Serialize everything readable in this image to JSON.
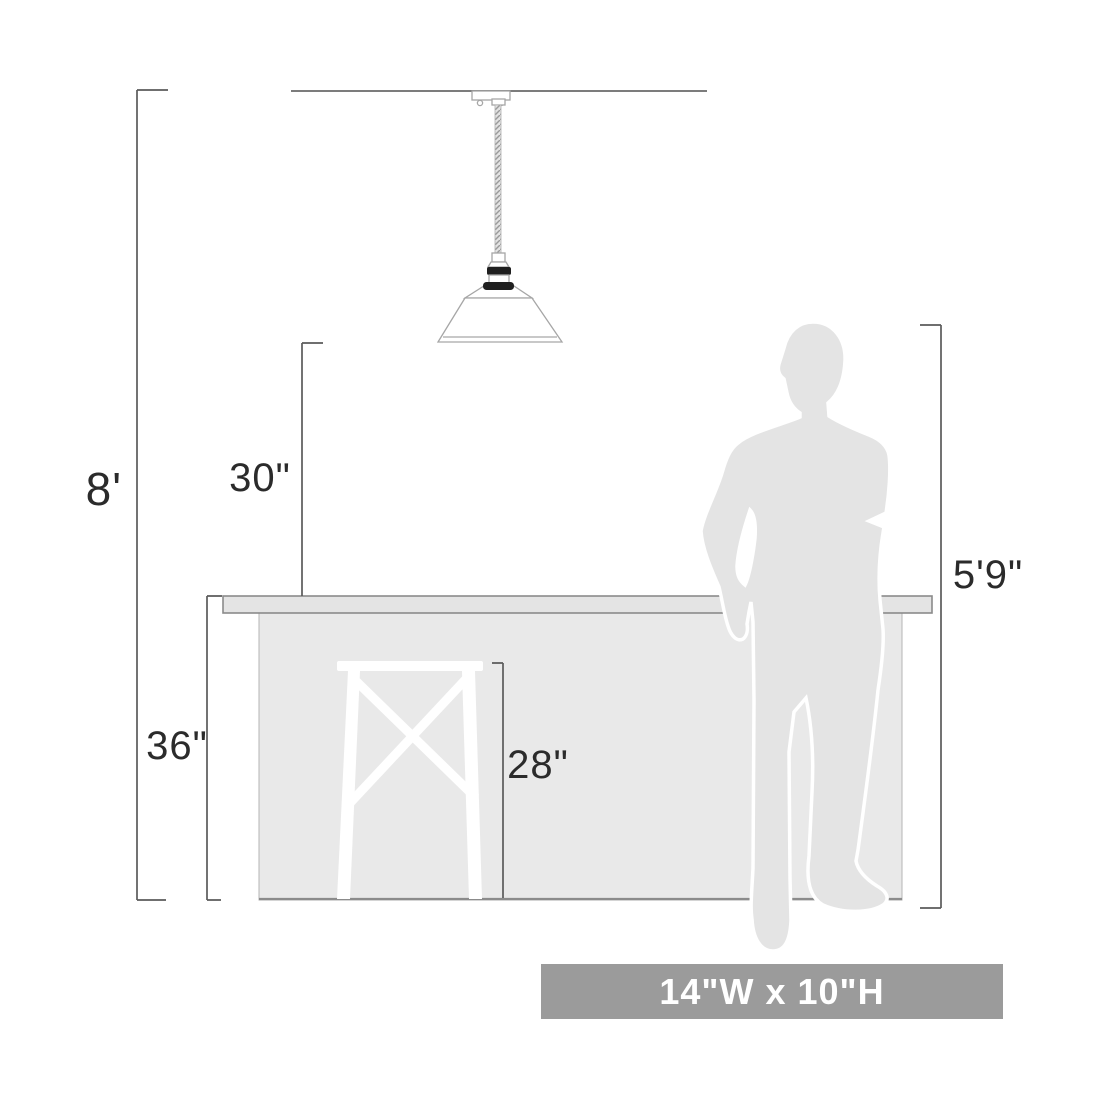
{
  "diagram": {
    "type": "product-dimension-diagram",
    "subject": "pendant light over kitchen counter with stool and human figure for scale",
    "labels": {
      "ceiling_height": "8'",
      "counter_to_fixture_bottom": "30\"",
      "counter_height": "36\"",
      "stool_seat_height": "28\"",
      "person_height": "5'9\"",
      "fixture_size": "14\"W x 10\"H"
    },
    "dimensions": [
      {
        "name": "ceiling-height",
        "value": "8'",
        "measures": "floor to ceiling"
      },
      {
        "name": "fixture-clearance",
        "value": "30\"",
        "measures": "counter top to shade bottom"
      },
      {
        "name": "counter-height",
        "value": "36\"",
        "measures": "floor to counter top"
      },
      {
        "name": "stool-height",
        "value": "28\"",
        "measures": "floor to stool seat"
      },
      {
        "name": "person-height",
        "value": "5'9\"",
        "measures": "height of human silhouette"
      },
      {
        "name": "fixture-size",
        "value": "14\"W x 10\"H",
        "measures": "shade width and height"
      }
    ],
    "colors": {
      "background": "#ffffff",
      "dimension_line": "#5b5b5b",
      "label_text": "#2b2b2b",
      "silhouette_gray": "#e4e4e4",
      "counter_gray": "#e9e9e9",
      "counter_outline": "#8b8b8b",
      "fixture_outline": "#a6a6a6",
      "socket_dark": "#1f1f1f",
      "banner_background": "#9b9b9b",
      "banner_text": "#ffffff"
    },
    "icons": [
      {
        "name": "pendant-light-drawing",
        "description": "line drawing of cone shade pendant on braided cord"
      },
      {
        "name": "person-silhouette",
        "description": "gray standing man in suit"
      },
      {
        "name": "stool-silhouette",
        "description": "white bar stool cutout with X cross braces"
      }
    ]
  }
}
